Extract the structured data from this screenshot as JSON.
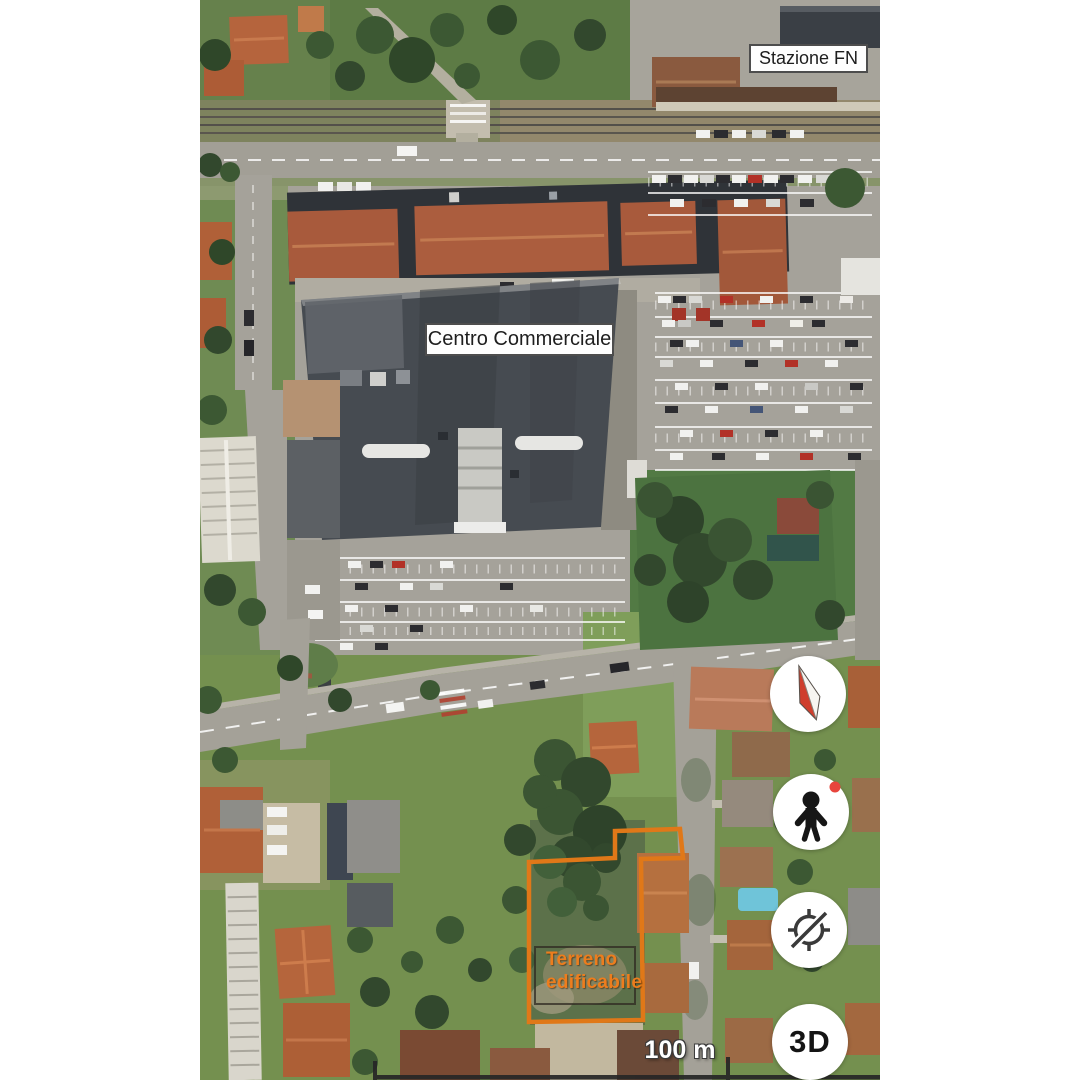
{
  "labels": {
    "station": "Stazione FN",
    "shopping_center": "Centro Commerciale",
    "parcel": {
      "line1": "Terreno",
      "line2": "edificabile"
    }
  },
  "controls": {
    "compass": {
      "name": "compass"
    },
    "pegman": {
      "name": "street-view-pegman"
    },
    "location": {
      "name": "location-disabled"
    },
    "three_d": {
      "label": "3D"
    }
  },
  "scale_bar": {
    "label": "100 m"
  },
  "colors": {
    "parcel_outline": "#e07818",
    "parcel_text": "#ed7d1d",
    "compass_red": "#cf3e2d",
    "compass_white": "#f7f5f1",
    "pegman_dot": "#e8453c",
    "icon_dark": "#333333",
    "button_bg": "#ffffff"
  }
}
